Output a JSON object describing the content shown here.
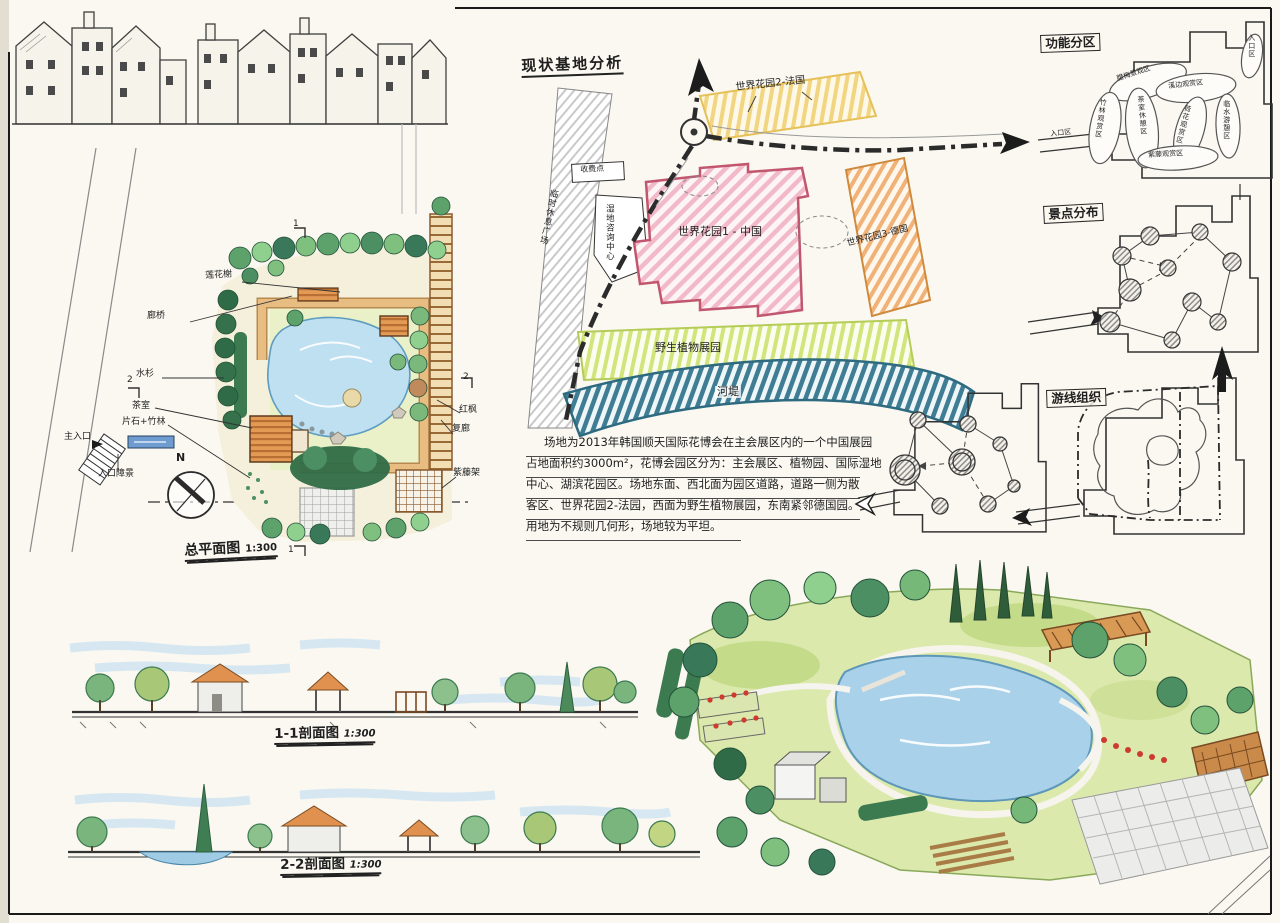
{
  "palette": {
    "paper": "#faf8f1",
    "ink": "#1f1f1f",
    "zone_yellow": "#f2d580",
    "zone_pink": "#f2b9c8",
    "zone_pink_edge": "#c2566f",
    "zone_orange": "#f0b276",
    "zone_green": "#d2e57c",
    "riverbank_teal": "#3e7d94",
    "pond_blue": "#aed4ea",
    "path_tan": "#dfaf74",
    "roof_orange": "#dd8f4d",
    "lawn_green": "#d9e6a5"
  },
  "site_analysis": {
    "title": "现状基地分析",
    "zones": {
      "garden2": "世界花园2-法国",
      "garden1": "世界花园1 - 中国",
      "garden3": "世界花园3-德国",
      "wild_plants": "野生植物展园",
      "river_bank": "河堤"
    },
    "facilities": {
      "toll": "收费点",
      "wetland_center": "湿地咨询中心",
      "temp_rest": "临时休息广场"
    },
    "description": [
      "场地为2013年韩国顺天国际花博会在主会展区内的一个中国展园",
      "占地面积约3000m²，花博会园区分为：主会展区、植物园、国际湿地",
      "中心、湖滨花园区。场地东面、西北面为园区道路，道路一侧为散",
      "客区、世界花园2-法园，西面为野生植物展园，东南紧邻德国园。",
      "用地为不规则几何形，场地较为平坦。"
    ]
  },
  "master_plan": {
    "title": "总平面图",
    "scale": "1:300",
    "north": "N",
    "section_mark_1": "1",
    "section_mark_2": "2",
    "labels": {
      "lotus_pavilion": "莲花榭",
      "corridor_bridge": "廊桥",
      "metasequoia": "水杉",
      "tea_house": "茶室",
      "stone_bamboo": "片石+竹林",
      "main_entrance": "主入口",
      "entrance_screen": "入口障景",
      "red_maple": "红枫",
      "double_corridor": "复廊",
      "wisteria_trellis": "紫藤架"
    }
  },
  "diagrams": {
    "functional": {
      "title": "功能分区",
      "bubbles": {
        "entrance_top": "入口区",
        "wintersweet": "腊梅景观区",
        "bamboo": "竹林观赏区",
        "tea_rest": "茶室休憩区",
        "stream": "溪边观赏区",
        "lotus": "荷花观赏区",
        "waterside": "临水游憩区",
        "wisteria": "紫藤观赏区",
        "entrance_bottom": "入口区"
      }
    },
    "scenic": {
      "title": "景点分布"
    },
    "routes": {
      "title": "游线组织"
    }
  },
  "sections": {
    "s11": {
      "title": "1-1剖面图",
      "scale": "1:300"
    },
    "s22": {
      "title": "2-2剖面图",
      "scale": "1:300"
    }
  }
}
